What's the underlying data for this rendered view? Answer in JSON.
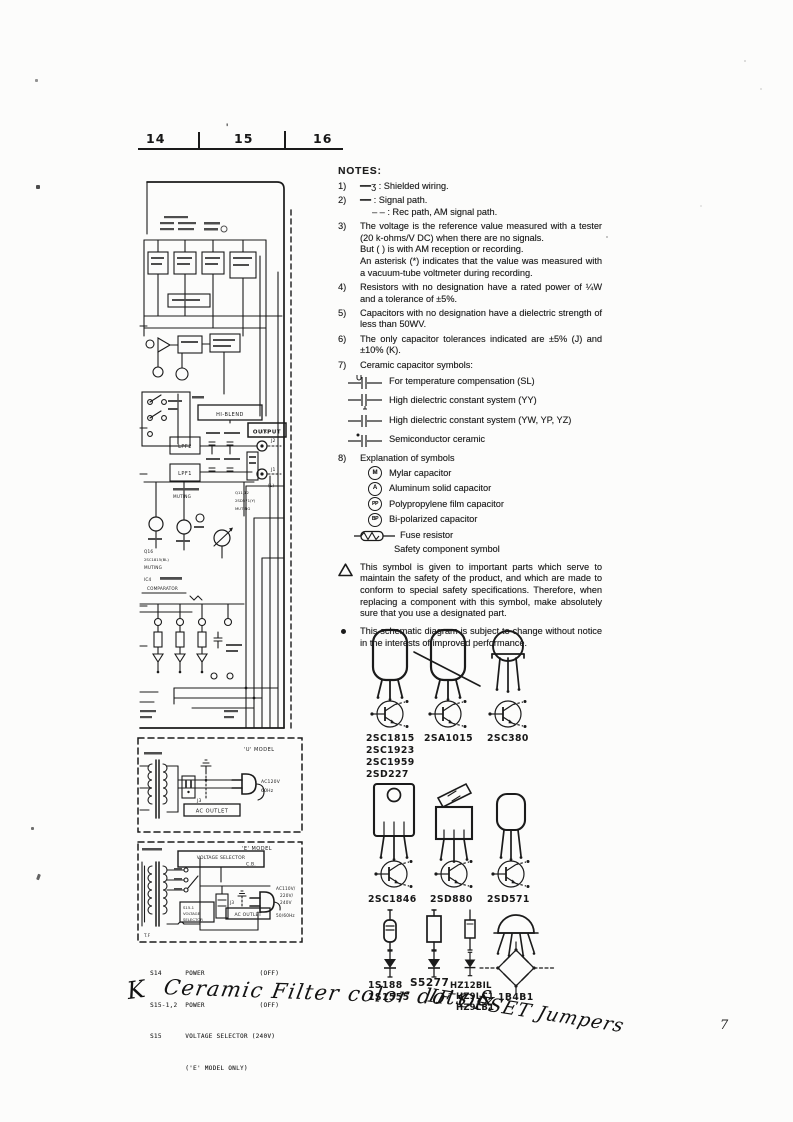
{
  "ruler": {
    "marks": [
      "14",
      "15",
      "16"
    ],
    "stray_mark": "'"
  },
  "notes": {
    "title": "NOTES:",
    "items": [
      {
        "num": "1)",
        "text": "━━ʒ : Shielded wiring."
      },
      {
        "num": "2)",
        "text": "━━ : Signal path.",
        "text2": "– – : Rec path, AM signal path."
      },
      {
        "num": "3)",
        "text": "The voltage is the reference value measured with a tester (20 k-ohms/V DC) when there are no signals.",
        "text2": "But (      ) is with AM reception or recording.",
        "text3": "An asterisk (*) indicates that the value was measured with a vacuum-tube voltmeter during recording."
      },
      {
        "num": "4)",
        "text": "Resistors with no designation have a rated power of ¼W and a tolerance of ±5%."
      },
      {
        "num": "5)",
        "text": "Capacitors with no designation have a dielectric strength of less than 50WV."
      },
      {
        "num": "6)",
        "text": "The only capacitor tolerances indicated are ±5% (J) and ±10% (K)."
      },
      {
        "num": "7)",
        "text": "Ceramic capacitor symbols:"
      },
      {
        "num": "8)",
        "text": "Explanation of symbols"
      }
    ],
    "cap_symbols": [
      {
        "label": "For temperature compensation (SL)"
      },
      {
        "label": "High dielectric constant system (YY)"
      },
      {
        "label": "High dielectric constant system (YW, YP, YZ)"
      },
      {
        "label": "Semiconductor ceramic"
      }
    ],
    "symbol_rows": [
      {
        "badge": "M",
        "label": "Mylar capacitor"
      },
      {
        "badge": "A",
        "label": "Aluminum solid capacitor"
      },
      {
        "badge": "PP",
        "label": "Polypropylene film capacitor"
      },
      {
        "badge": "BP",
        "label": "Bi-polarized capacitor"
      }
    ],
    "fuse_label": "Fuse resistor",
    "safety_label": "Safety component symbol",
    "warning_text": "This symbol is given to important parts which serve to maintain the safety of the product, and which are made to conform to special safety specifications. Therefore, when replacing a component with this symbol, make absolutely sure that you use a designated part.",
    "change_text": "This schematic diagram is subject to change without notice in the interests of improved performance."
  },
  "schematic": {
    "hi_blend": "HI-BLEND",
    "output": "OUTPUT",
    "lpf2": "LPF2",
    "lpf1": "LPF1",
    "j2": "J2",
    "j2_ch": "(R)",
    "j1": "J1",
    "j1_ch": "(L)",
    "muting_a": "MUTING",
    "q11_ref": "Q11,12",
    "q11_part": "2SD571(Y)",
    "q11_fn": "MUTING",
    "q16_ref": "Q16",
    "q16_part": "2SC1815(BL)",
    "q16_fn": "MUTING",
    "ic4_ref": "IC4",
    "ic4_fn": "COMPARATOR"
  },
  "u_model": {
    "title": "'U' MODEL",
    "j3": "J3",
    "ac_outlet": "AC OUTLET",
    "voltage": "AC120V",
    "freq": "60Hz"
  },
  "e_model": {
    "title": "'E' MODEL",
    "selector": "VOLTAGE SELECTOR",
    "cb": "C.B.",
    "s15": "S15-1",
    "s15b": "VOLTAGE",
    "s15c": "SELECTOR",
    "j3": "J3",
    "ac_outlet": "AC OUTLET",
    "v1": "AC110V/",
    "v2": "220V/",
    "v3": "240V",
    "freq": "50/60Hz",
    "tf": "T.F"
  },
  "switch_legend": {
    "l1": "S14      POWER              (OFF)",
    "l2": "S15-1,2  POWER              (OFF)",
    "l3": "S15      VOLTAGE SELECTOR (240V)",
    "l4": "         ('E' MODEL ONLY)"
  },
  "semiconductors": {
    "row1": {
      "g1": [
        "2SC1815",
        "2SC1923",
        "2SC1959",
        "2SD227"
      ],
      "g2": "2SA1015",
      "g3": "2SC380"
    },
    "row2": {
      "g1": "2SC1846",
      "g2": "2SD880",
      "g3": "2SD571"
    },
    "row3": {
      "g1a": "1S188",
      "g1b": "1S1555",
      "g2": "S5277",
      "g3a": "HZ12BIL",
      "g3b": "HZ9LC1",
      "g3c": "HZ9LB1",
      "g4": "1B4B1"
    }
  },
  "handwriting": {
    "k": "K",
    "line1": "Ceramic Filter color dots &",
    "line2": "IF OFSET Jumpers"
  },
  "page_number": "7"
}
